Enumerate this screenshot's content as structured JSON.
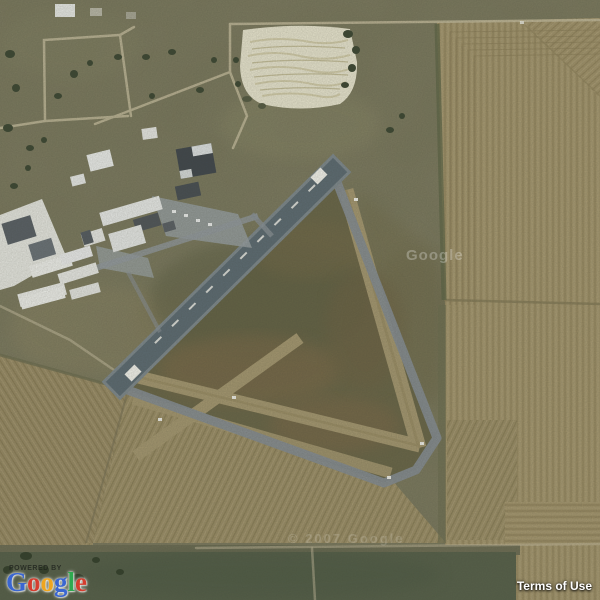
{
  "attribution": {
    "powered_by": "POWERED BY",
    "logo_letters": [
      {
        "ch": "G",
        "color": "#3a66d1"
      },
      {
        "ch": "o",
        "color": "#d53d2e"
      },
      {
        "ch": "o",
        "color": "#efa51e"
      },
      {
        "ch": "g",
        "color": "#3a66d1"
      },
      {
        "ch": "l",
        "color": "#2ea94f"
      },
      {
        "ch": "e",
        "color": "#d53d2e"
      }
    ],
    "terms_label": "Terms of Use"
  },
  "watermarks": {
    "center": {
      "text": "Google"
    },
    "bottom": {
      "text": "© 2007 Google"
    }
  },
  "map": {
    "view_type": "satellite",
    "visible_features": [
      "triangular-airfield",
      "paved-runway-with-white-centerline",
      "dirt-runways-crossing",
      "perimeter-taxiway",
      "hangar-and-industrial-buildings",
      "lumber-yard-white-roofs",
      "white-gravel-patch",
      "plowed-contour-fields",
      "dirt-roads",
      "scattered-trees"
    ]
  },
  "palette": {
    "grass_base": "#78775c",
    "field_tan": "#a3956d",
    "furrow_dark": "#8c7e58",
    "infield_olive": "#6a6749",
    "runway_paved": "#5c6b73",
    "taxiway_gray": "#868d92",
    "runway_dirt": "#a59871",
    "white_patch": "#eae7d1",
    "dark_band": "#57614b",
    "building_white": "#eceeec",
    "building_dark": "#40474d",
    "tree_green": "#3c4733",
    "road_tan": "#c4bc9e",
    "marking_white": "#f4f4ee"
  }
}
